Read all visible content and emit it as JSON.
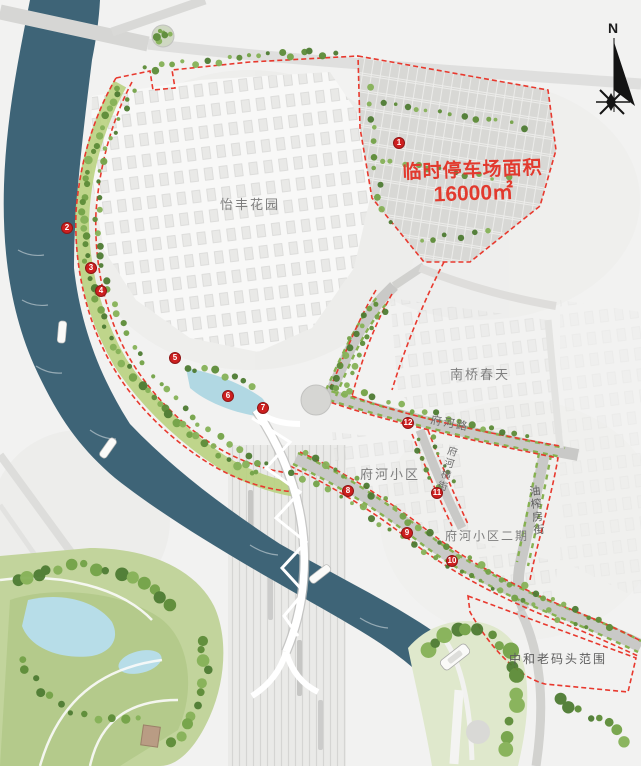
{
  "colors": {
    "river": "#3e6477",
    "boundary": "#e8392e",
    "marker": "#cd1f1f",
    "note": "#e23a2e",
    "label": "#7e7e7e"
  },
  "note": {
    "line1": "临时停车场面积",
    "line2": "16000㎡"
  },
  "compass": {
    "label": "N"
  },
  "areas": {
    "yifeng": "怡丰花园",
    "nanqiao": "南桥春天",
    "fuhe": "府河小区",
    "fuhe_phase2": "府河小区二期",
    "wharf": "中和老码头范围"
  },
  "streets": {
    "fuhe_road": "府河路",
    "fuhe_heng_street": "府河横街",
    "youzhafang_street": "油榨房街"
  },
  "markers": [
    {
      "n": "1",
      "x": 399,
      "y": 143
    },
    {
      "n": "2",
      "x": 67,
      "y": 228
    },
    {
      "n": "3",
      "x": 91,
      "y": 268
    },
    {
      "n": "4",
      "x": 101,
      "y": 291
    },
    {
      "n": "5",
      "x": 175,
      "y": 358
    },
    {
      "n": "6",
      "x": 228,
      "y": 396
    },
    {
      "n": "7",
      "x": 263,
      "y": 408
    },
    {
      "n": "8",
      "x": 348,
      "y": 491
    },
    {
      "n": "9",
      "x": 407,
      "y": 533
    },
    {
      "n": "10",
      "x": 452,
      "y": 561
    },
    {
      "n": "11",
      "x": 437,
      "y": 493
    },
    {
      "n": "12",
      "x": 408,
      "y": 423
    }
  ]
}
